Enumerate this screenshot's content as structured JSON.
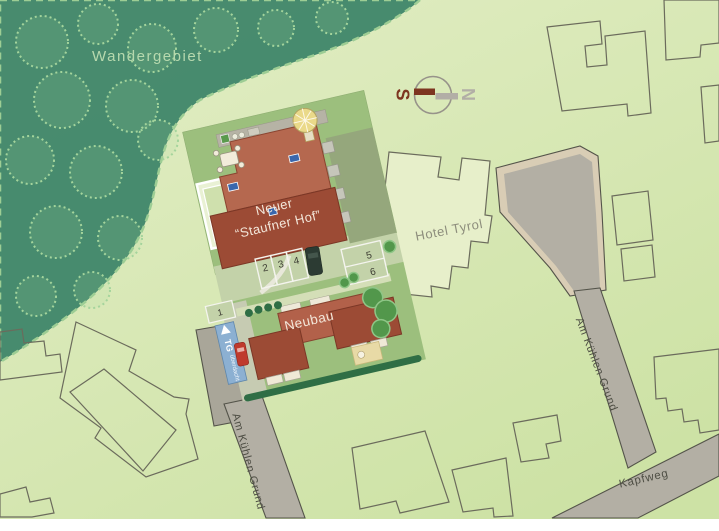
{
  "labels": {
    "forest": "Wandergebiet",
    "main_building_line1": "Neuer",
    "main_building_line2": "“Staufner Hof”",
    "hotel": "Hotel Tyrol",
    "neubau": "Neubau",
    "street_left": "Am Kühlen Grund",
    "street_right": "Am Kühlen Grund",
    "street_bottom": "Kapfweg",
    "garage_abbr": "TG",
    "garage_note": "überdacht",
    "compass_south": "S",
    "compass_north": "N"
  },
  "parking_stalls": [
    "1",
    "2",
    "3",
    "4",
    "5",
    "6"
  ],
  "colors": {
    "forest": "#458a6d",
    "forest_foliage": "#a4d49c",
    "background_light": "#e3eec6",
    "background_dark": "#cde2a5",
    "road": "#b3afa4",
    "road_apron": "#a9a699",
    "road_edge_tan": "#d9cdb5",
    "site_lawn": "#9cbf7d",
    "parking_strip": "#c3d2a9",
    "building_roof_light": "#b5684f",
    "building_roof_dark": "#9c4b35",
    "hotel_fill": "#e7efca",
    "outline_stroke": "#6b6b5c",
    "hedge": "#2f6e45",
    "tree": "#52974b",
    "garage_ramp_blue": "#8cb0d2",
    "window_marker_blue": "#3a67ad",
    "compass_south_red": "#7d3520",
    "compass_north_gray": "#b2aea6",
    "car_red": "#bf3a2d",
    "car_dark": "#2c3b33"
  }
}
